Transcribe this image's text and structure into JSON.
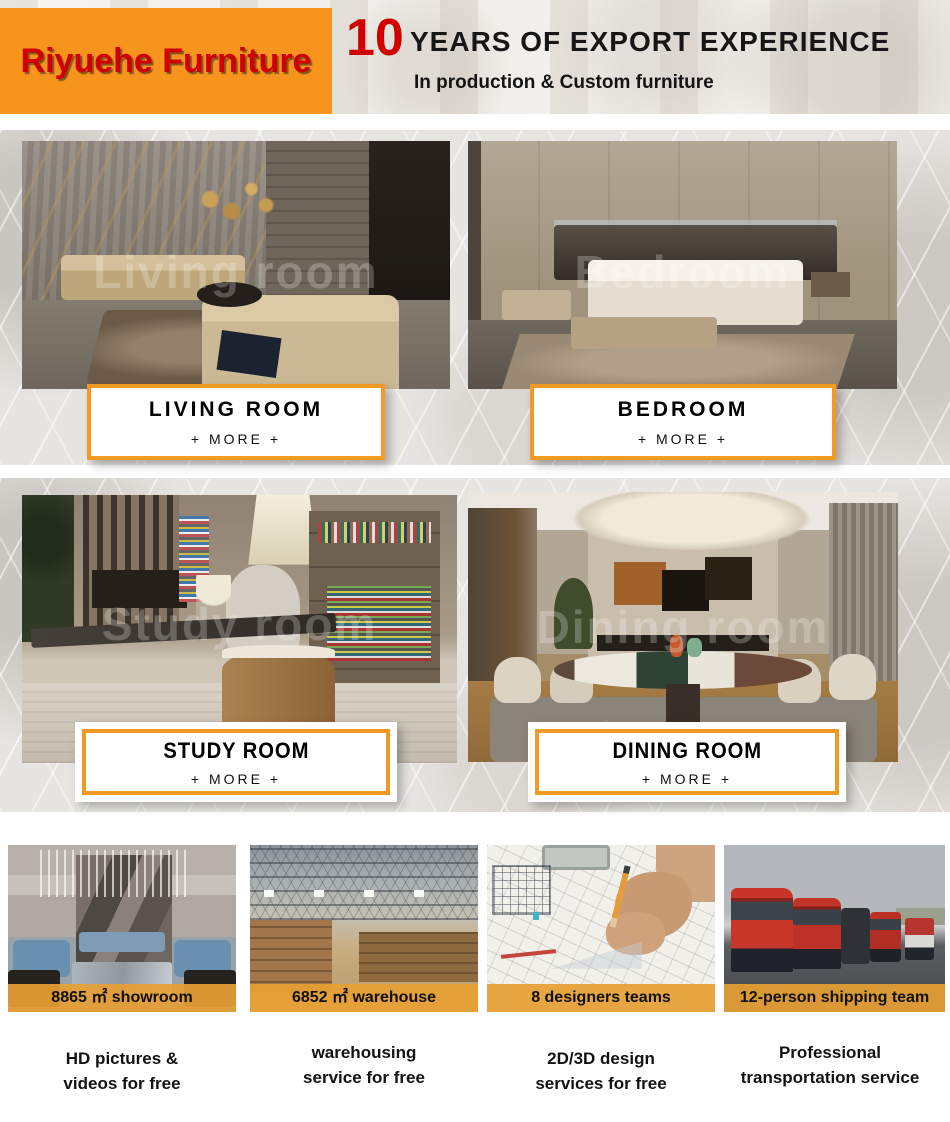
{
  "header": {
    "brand": "Riyuehe Furniture",
    "years_number": "10",
    "title": "YEARS OF EXPORT EXPERIENCE",
    "subtitle": "In production & Custom furniture"
  },
  "colors": {
    "header_orange": "#F7941D",
    "brand_red": "#D10000",
    "card_border_orange": "#F29A24",
    "caption_bar_orange": "#E79F34"
  },
  "rooms": [
    {
      "label": "LIVING ROOM",
      "more": "+ MORE +",
      "watermark": "Living room"
    },
    {
      "label": "BEDROOM",
      "more": "+ MORE +",
      "watermark": "Bedroom"
    },
    {
      "label": "STUDY ROOM",
      "more": "+ MORE +",
      "watermark": "Study room"
    },
    {
      "label": "DINING ROOM",
      "more": "+ MORE +",
      "watermark": "Dining room"
    }
  ],
  "facilities": [
    {
      "caption": "8865 ㎡ showroom",
      "service_line1": "HD pictures &",
      "service_line2": "videos for free"
    },
    {
      "caption": "6852 ㎡ warehouse",
      "service_line1": "warehousing",
      "service_line2": "service for free"
    },
    {
      "caption": "8 designers teams",
      "service_line1": "2D/3D design",
      "service_line2": "services for free"
    },
    {
      "caption": "12-person shipping team",
      "service_line1": "Professional",
      "service_line2": "transportation service"
    }
  ]
}
